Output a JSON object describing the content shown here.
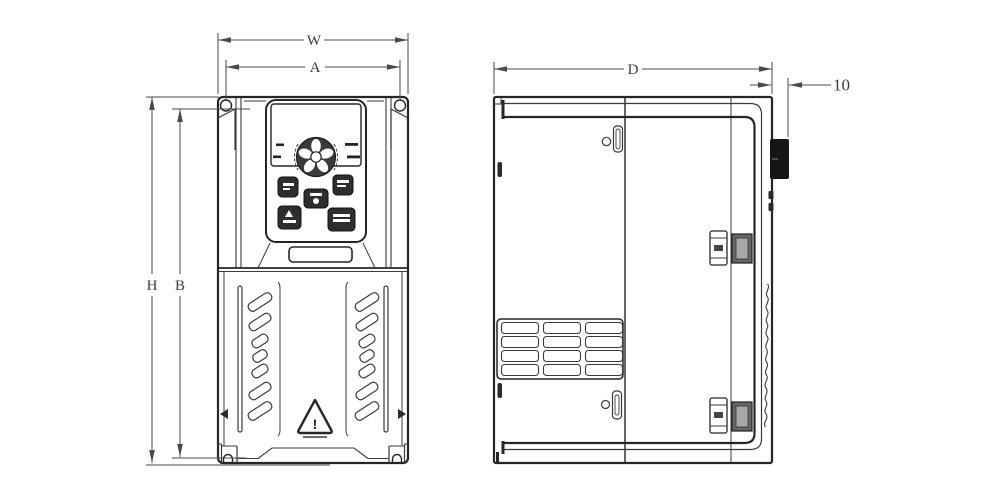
{
  "drawing": {
    "dimension_labels": {
      "overall_width": "W",
      "mounting_width": "A",
      "overall_height": "H",
      "mounting_height": "B",
      "overall_depth": "D",
      "protrusion_depth": "10"
    },
    "front_view": {
      "warning_glyph": "!"
    },
    "colors": {
      "object_line": "#262626",
      "dimension_line": "#4a4a4a",
      "dark_fill": "#2e2e2e",
      "background": "#ffffff"
    }
  }
}
